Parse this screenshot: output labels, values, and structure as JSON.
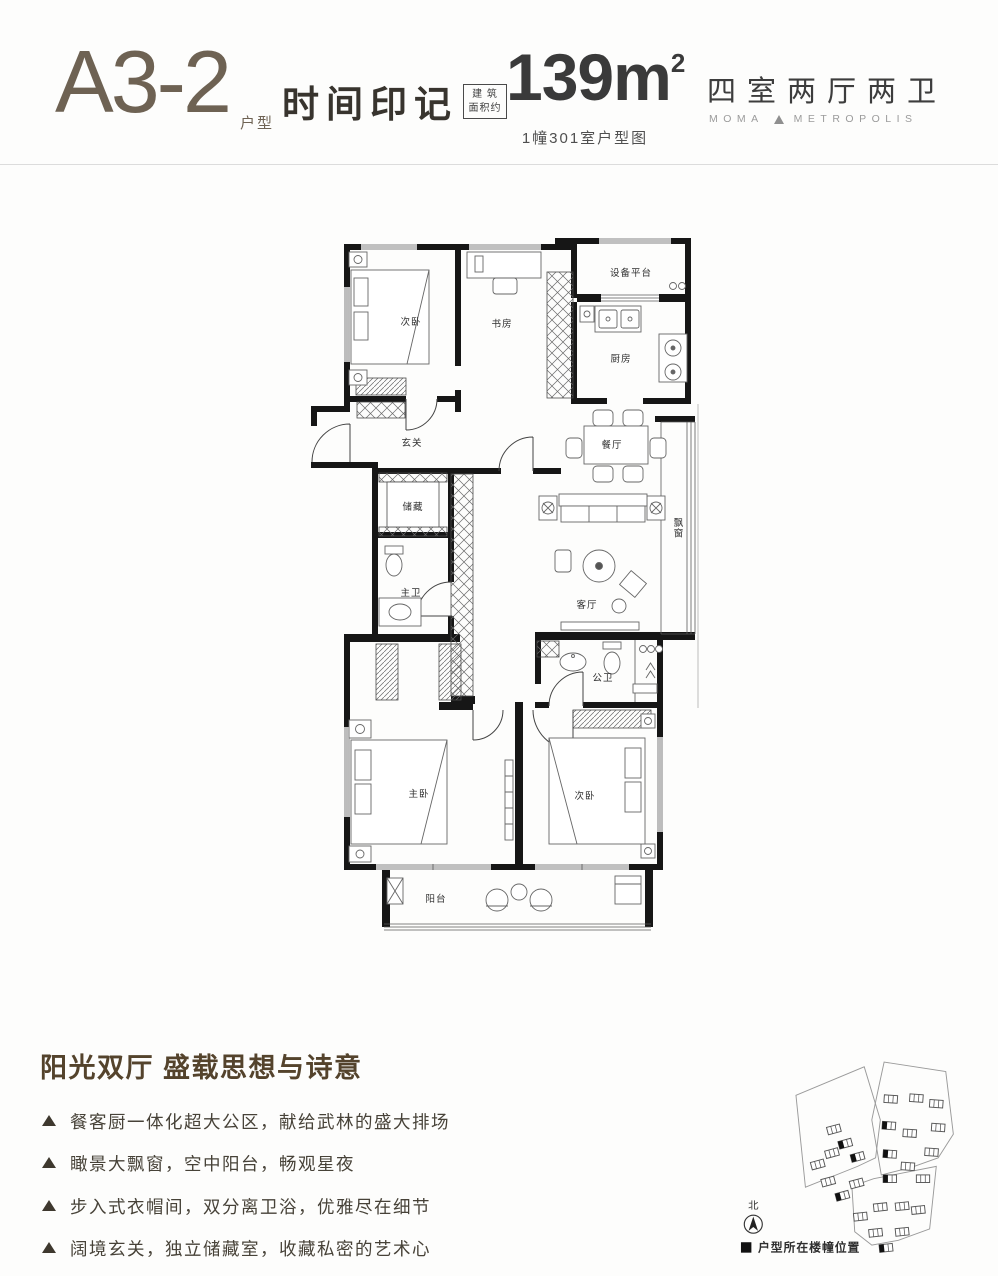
{
  "header": {
    "unit_code": "A3-2",
    "unit_code_suffix": "户型",
    "series_name": "时间印记",
    "area_box": {
      "line1": "建 筑",
      "line2": "面积约"
    },
    "area_value": "139m",
    "area_sup": "2",
    "unit_note": "1幢301室户型图",
    "layout_type": "四室两厅两卫",
    "brand": {
      "left": "MOMA",
      "right": "METROPOLIS"
    }
  },
  "floorplan": {
    "rooms": {
      "bedroom_top": "次卧",
      "study": "书房",
      "equipment": "设备平台",
      "kitchen": "厨房",
      "foyer": "玄关",
      "dining": "餐厅",
      "storage": "储藏",
      "master_bath": "主卫",
      "living": "客厅",
      "bay_window": "飘窗",
      "public_bath": "公卫",
      "master_bedroom": "主卧",
      "bedroom_bottom": "次卧",
      "balcony": "阳台"
    }
  },
  "features": {
    "title": "阳光双厅 盛载思想与诗意",
    "items": [
      "餐客厨一体化超大公区，献给武林的盛大排场",
      "瞰景大飘窗，空中阳台，畅观星夜",
      "步入式衣帽间，双分离卫浴，优雅尽在细节",
      "阔境玄关，独立储藏室，收藏私密的艺术心"
    ]
  },
  "siteplan": {
    "north": "北",
    "legend": "户型所在楼幢位置"
  },
  "colors": {
    "accent": "#6e6253",
    "heading": "#54432c",
    "wall": "#161616",
    "divider": "#dcdcdc"
  }
}
